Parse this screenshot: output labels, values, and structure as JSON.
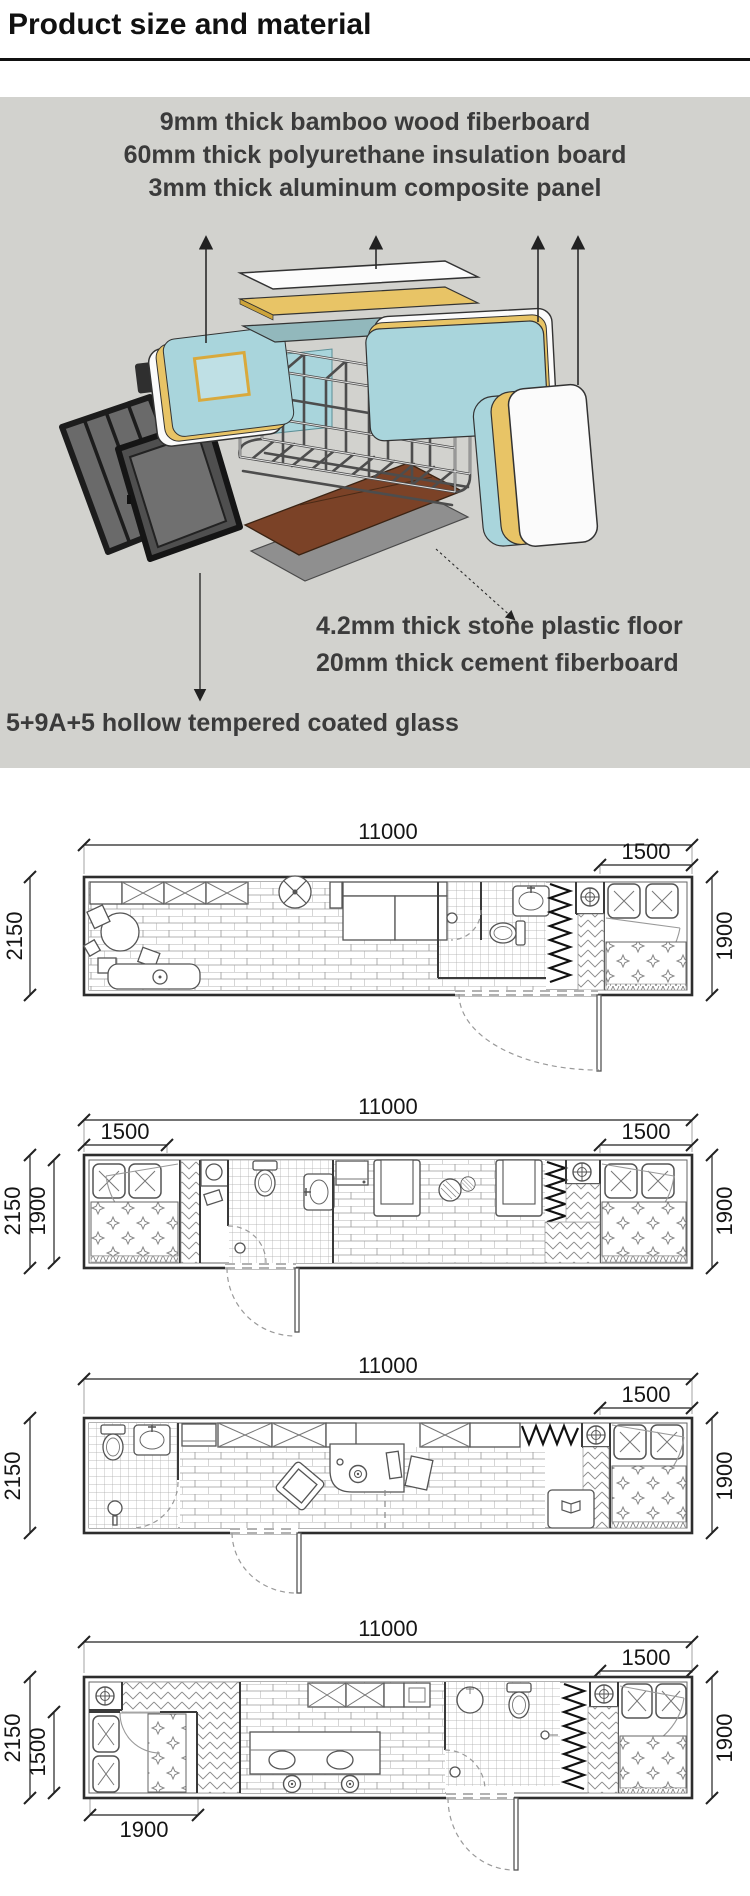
{
  "header": {
    "title": "Product size and material"
  },
  "materials": {
    "top_labels": [
      "9mm thick bamboo wood fiberboard",
      "60mm thick polyurethane insulation board",
      "3mm thick aluminum composite panel"
    ],
    "floor_labels": [
      "4.2mm thick stone plastic floor",
      "20mm thick cement fiberboard"
    ],
    "glass_label": "5+9A+5 hollow tempered coated glass"
  },
  "colors": {
    "section_bg": "#d2d2ce",
    "panel_teal": "#a9d5dc",
    "panel_yellow": "#e8c466",
    "panel_white": "#fbfbfb",
    "roof_teal": "#92b8bc",
    "floor_brown": "#7b4227",
    "underlay_gray": "#8f8f8f",
    "glass_gray": "#6a6a6a",
    "frame_black": "#1c1c1c",
    "line_dark": "#1a1a1a"
  },
  "plans": [
    {
      "id": "plan-1",
      "dims": {
        "top": "11000",
        "top_right": "1500",
        "left": "2150",
        "right": "1900"
      }
    },
    {
      "id": "plan-2",
      "dims": {
        "top": "11000",
        "top_left": "1500",
        "top_right": "1500",
        "left_outer": "2150",
        "left_inner": "1900",
        "right": "1900"
      }
    },
    {
      "id": "plan-3",
      "dims": {
        "top": "11000",
        "top_right": "1500",
        "left": "2150",
        "right": "1900"
      }
    },
    {
      "id": "plan-4",
      "dims": {
        "top": "11000",
        "top_right": "1500",
        "left_outer": "2150",
        "left_inner": "1500",
        "right": "1900",
        "bottom_left": "1900"
      }
    }
  ]
}
